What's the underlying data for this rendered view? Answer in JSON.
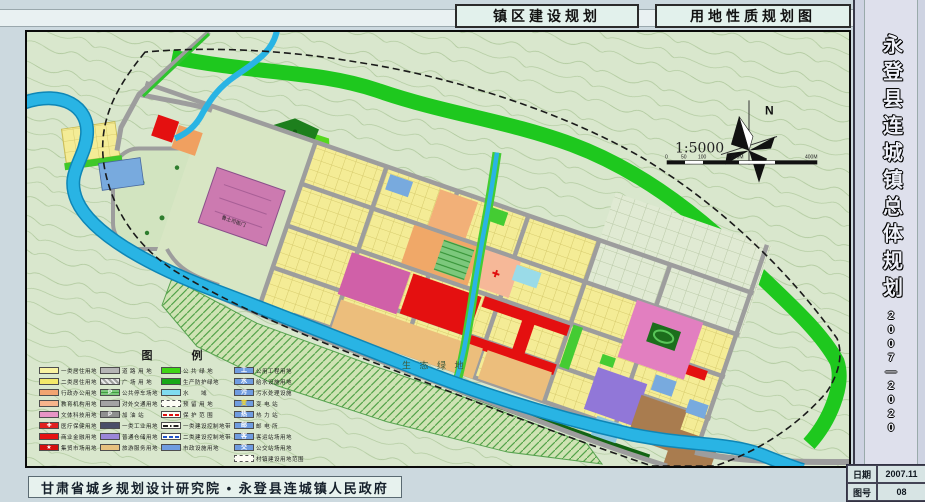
{
  "header": {
    "left_title": "镇区建设规划",
    "right_title": "用地性质规划图"
  },
  "sidebar": {
    "title": "永登县连城镇总体规划",
    "years": "2007—2020",
    "info_rows": [
      {
        "label": "日期",
        "value": "2007.11"
      },
      {
        "label": "图号",
        "value": "08"
      }
    ]
  },
  "footer": {
    "credit": "甘肃省城乡规划设计研究院 • 永登县连城镇人民政府"
  },
  "map": {
    "labels": {
      "north": "N",
      "scale": "1:5000",
      "heritage": "鲁土司衙门",
      "eco_area": "生 态 绿 地"
    },
    "scale_ticks": [
      "0",
      "50",
      "100",
      "200M",
      "400M"
    ],
    "colors": {
      "residential": "#f4ec96",
      "commercial": "#e41010",
      "road": "#9d9d9d",
      "water": "#29b4e4",
      "green_belt": "#1ec81e",
      "warehouse": "#9177d8",
      "storage": "#a97c4f",
      "utility_blue": "#6f9ce0"
    },
    "legend": {
      "title": "图　例",
      "columns": [
        [
          {
            "label": "一类居住用地",
            "sw": {
              "t": "fill",
              "c": "#f9f3a2"
            }
          },
          {
            "label": "二类居住用地",
            "sw": {
              "t": "fill",
              "c": "#f3e96a"
            }
          },
          {
            "label": "行政办公用地",
            "sw": {
              "t": "fill",
              "c": "#f2a470"
            }
          },
          {
            "label": "教育机构用地",
            "sw": {
              "t": "fill",
              "c": "#f6b48c"
            }
          },
          {
            "label": "文体科技用地",
            "sw": {
              "t": "fill",
              "c": "#e795c5"
            }
          },
          {
            "label": "医疗保健用地",
            "sw": {
              "t": "fill",
              "c": "#e02020",
              "icon": "✚",
              "ic": "#ffffff"
            }
          },
          {
            "label": "商业金融用地",
            "sw": {
              "t": "fill",
              "c": "#e61212"
            }
          },
          {
            "label": "集贸市场用地",
            "sw": {
              "t": "fill",
              "c": "#d40f0f",
              "icon": "★",
              "ic": "#ffffff"
            }
          }
        ],
        [
          {
            "label": "道 路 用 地",
            "sw": {
              "t": "fill",
              "c": "#b5b5b5"
            }
          },
          {
            "label": "广 场 用 地",
            "sw": {
              "t": "hatch",
              "c": "#9e9e9e"
            }
          },
          {
            "label": "公共停车场地",
            "sw": {
              "t": "pk",
              "icon": "P",
              "ic": "#ffffff"
            }
          },
          {
            "label": "对外交通用地",
            "sw": {
              "t": "fill",
              "c": "#a3a3a3"
            }
          },
          {
            "label": "加 油 站",
            "sw": {
              "t": "fill",
              "c": "#8f8f8f",
              "icon": "P",
              "ic": "#ffffff"
            }
          },
          {
            "label": "一类工业用地",
            "sw": {
              "t": "fill",
              "c": "#4a4e68"
            }
          },
          {
            "label": "普通仓储用地",
            "sw": {
              "t": "fill",
              "c": "#9a86d8"
            }
          },
          {
            "label": "旅游服务用地",
            "sw": {
              "t": "fill",
              "c": "#e7c17f"
            }
          }
        ],
        [
          {
            "label": "公 共 绿 地",
            "sw": {
              "t": "fill",
              "c": "#3fd615"
            }
          },
          {
            "label": "生产防护绿地",
            "sw": {
              "t": "fill",
              "c": "#18a818"
            }
          },
          {
            "label": "水　　域",
            "sw": {
              "t": "fill",
              "c": "#7fdcf0"
            }
          },
          {
            "label": "预 留 用 地",
            "sw": {
              "t": "dashbox"
            }
          },
          {
            "label": "保 护 范 围",
            "sw": {
              "t": "line",
              "style": "dashed",
              "c": "#e01010"
            }
          },
          {
            "label": "一类建设控制地带",
            "sw": {
              "t": "line",
              "style": "dashdot",
              "c": "#222222"
            }
          },
          {
            "label": "二类建设控制地带",
            "sw": {
              "t": "line",
              "style": "dashed",
              "c": "#2255cc"
            }
          },
          {
            "label": "市政设施用地",
            "sw": {
              "t": "fill",
              "c": "#6f9ce0"
            }
          }
        ],
        [
          {
            "label": "公用工程用地",
            "sw": {
              "t": "fill",
              "c": "#6f9ce0",
              "icon": "工",
              "ic": "#ffffff"
            }
          },
          {
            "label": "给水设施用地",
            "sw": {
              "t": "fill",
              "c": "#6f9ce0",
              "icon": "水",
              "ic": "#ffffff"
            }
          },
          {
            "label": "污水处理设施",
            "sw": {
              "t": "fill",
              "c": "#6f9ce0",
              "icon": "污",
              "ic": "#ffffff"
            }
          },
          {
            "label": "变 电 站",
            "sw": {
              "t": "fill",
              "c": "#6f9ce0",
              "icon": "变",
              "ic": "#ffdd22"
            }
          },
          {
            "label": "热 力 站",
            "sw": {
              "t": "fill",
              "c": "#6f9ce0",
              "icon": "热",
              "ic": "#ffffff"
            }
          },
          {
            "label": "邮 电 所",
            "sw": {
              "t": "fill",
              "c": "#6f9ce0",
              "icon": "邮",
              "ic": "#ffffff"
            }
          },
          {
            "label": "客运站场用地",
            "sw": {
              "t": "fill",
              "c": "#6f9ce0",
              "icon": "客",
              "ic": "#ffffff"
            }
          },
          {
            "label": "公交站场用地",
            "sw": {
              "t": "fill",
              "c": "#6f9ce0",
              "icon": "交",
              "ic": "#ffffff"
            }
          },
          {
            "label": "村镇建设用地范围",
            "sw": {
              "t": "dashbox"
            }
          }
        ]
      ]
    }
  }
}
